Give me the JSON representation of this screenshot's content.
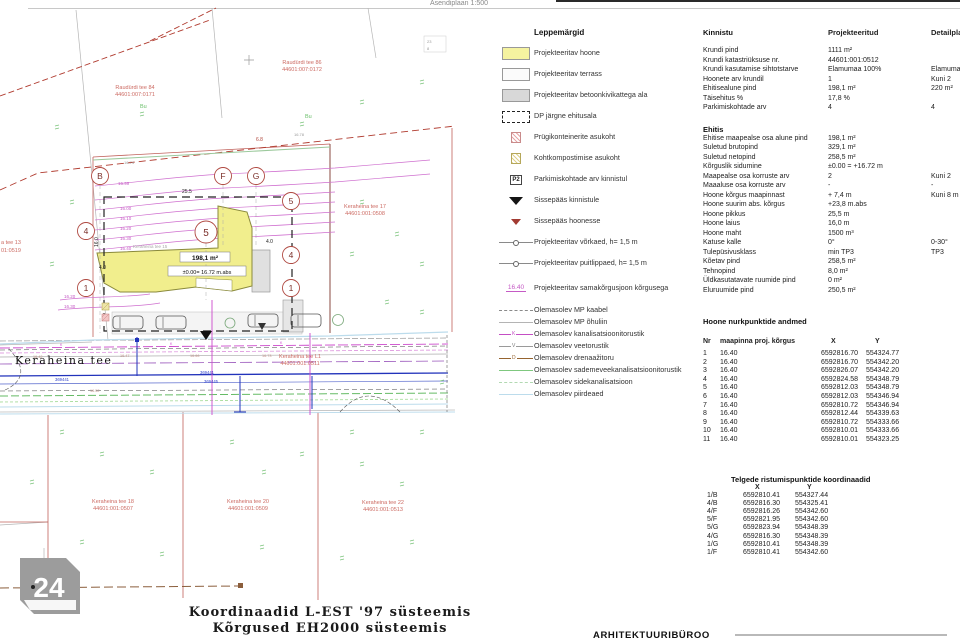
{
  "header": {
    "title": "Asendiplaan 1:500"
  },
  "legend": {
    "title": "Leppemärgid",
    "items": [
      {
        "symbol": "swatch-yellow",
        "label": "Projekteeritav hoone"
      },
      {
        "symbol": "swatch-white",
        "label": "Projekteeritav terrass"
      },
      {
        "symbol": "swatch-gray",
        "label": "Projekteeritav betoonkivikattega ala"
      },
      {
        "symbol": "dashed-bracket",
        "label": "DP järgne ehitusala"
      },
      {
        "symbol": "hatch-pink",
        "label": "Prügikonteinerite asukoht"
      },
      {
        "symbol": "hatch-yellow",
        "label": "Kohtkompostimise asukoht"
      },
      {
        "symbol": "p-box",
        "symbol_text": "P2",
        "label": "Parkimiskohtade arv kinnistul"
      },
      {
        "symbol": "triangle-black",
        "label": "Sissepääs kinnistule"
      },
      {
        "symbol": "triangle-red",
        "label": "Sissepääs hoonesse"
      },
      {
        "symbol": "fence-line",
        "label": "Projekteeritav võrkaed, h= 1,5 m"
      },
      {
        "symbol": "fence-line",
        "label": "Projekteeritav puitlippaed, h= 1,5 m"
      },
      {
        "symbol": "contour-label",
        "symbol_text": "16.40",
        "label": "Projekteeritav samakõrgusjoon kõrgusega"
      },
      {
        "symbol": "line-gray-dash",
        "label": "Olemasolev MP kaabel"
      },
      {
        "symbol": "line-gray",
        "label": "Olemasolev MP õhuliin"
      },
      {
        "symbol": "line-magenta",
        "symbol_text": "K",
        "label": "Olemasolev kanalisatsioonitorustik"
      },
      {
        "symbol": "line-gray-v",
        "symbol_text": "V",
        "label": "Olemasolev veetorustik"
      },
      {
        "symbol": "line-brown",
        "symbol_text": "D",
        "label": "Olemasolev drenaažitoru"
      },
      {
        "symbol": "line-green",
        "label": "Olemasolev sademeveekanalisatsioonitorustik"
      },
      {
        "symbol": "line-lightgreen",
        "label": "Olemasolev sidekanalisatsioon"
      },
      {
        "symbol": "line-lightblue",
        "label": "Olemasolev piirdeaed"
      }
    ]
  },
  "kinnistu": {
    "title": "Kinnistu",
    "col_projected": "Projekteeritud",
    "col_detail": "Detailplaneering",
    "rows": [
      {
        "label": "Krundi pind",
        "value": "1111 m²",
        "detail": ""
      },
      {
        "label": "Krundi katastriüksuse nr.",
        "value": "44601:001:0512",
        "detail": ""
      },
      {
        "label": "Krundi kasutamise sihtotstarve",
        "value": "Elamumaa 100%",
        "detail": "Elamumaa"
      },
      {
        "label": "Hoonete arv krundil",
        "value": "1",
        "detail": "Kuni 2"
      },
      {
        "label": "Ehitisealune pind",
        "value": "198,1 m²",
        "detail": "220 m²"
      },
      {
        "label": "Täisehitus %",
        "value": "17,8 %",
        "detail": ""
      },
      {
        "label": "Parkimiskohtade arv",
        "value": "4",
        "detail": "4"
      }
    ]
  },
  "ehitis": {
    "title": "Ehitis",
    "rows": [
      {
        "label": "Ehitise maapealse osa alune pind",
        "value": "198,1 m²",
        "detail": ""
      },
      {
        "label": "Suletud brutopind",
        "value": "329,1 m²",
        "detail": ""
      },
      {
        "label": "Suletud netopind",
        "value": "258,5 m²",
        "detail": ""
      },
      {
        "label": "Kõrguslik sidumine",
        "value": "±0.00 = +16.72 m",
        "detail": ""
      },
      {
        "label": "Maapealse osa korruste arv",
        "value": "2",
        "detail": "Kuni 2"
      },
      {
        "label": "Maaaluse osa korruste arv",
        "value": "-",
        "detail": "-"
      },
      {
        "label": "Hoone kõrgus maapinnast",
        "value": "+ 7,4 m",
        "detail": "Kuni 8 m"
      },
      {
        "label": "Hoone suurim abs. kõrgus",
        "value": "+23,8 m.abs",
        "detail": ""
      },
      {
        "label": "Hoone pikkus",
        "value": "25,5 m",
        "detail": ""
      },
      {
        "label": "Hoone laius",
        "value": "16,0 m",
        "detail": ""
      },
      {
        "label": "Hoone maht",
        "value": "1500 m³",
        "detail": ""
      },
      {
        "label": "Katuse kalle",
        "value": "0°",
        "detail": "0-30°"
      },
      {
        "label": "Tulepüsivusklass",
        "value": "min TP3",
        "detail": "TP3"
      },
      {
        "label": "Kõetav pind",
        "value": "258,5 m²",
        "detail": ""
      },
      {
        "label": "Tehnopind",
        "value": "8,0 m²",
        "detail": ""
      },
      {
        "label": "Üldkasutatavate ruumide pind",
        "value": "0 m²",
        "detail": ""
      },
      {
        "label": "Eluruumide pind",
        "value": "250,5 m²",
        "detail": ""
      }
    ]
  },
  "corner_points": {
    "title": "Hoone nurkpunktide andmed",
    "col_nr": "Nr",
    "col_h": "maapinna proj. kõrgus",
    "col_x": "X",
    "col_y": "Y",
    "rows": [
      {
        "nr": "1",
        "h": "16.40",
        "x": "6592816.70",
        "y": "554324.77"
      },
      {
        "nr": "2",
        "h": "16.40",
        "x": "6592816.70",
        "y": "554342.20"
      },
      {
        "nr": "3",
        "h": "16.40",
        "x": "6592826.07",
        "y": "554342.20"
      },
      {
        "nr": "4",
        "h": "16.40",
        "x": "6592824.58",
        "y": "554348.79"
      },
      {
        "nr": "5",
        "h": "16.40",
        "x": "6592812.03",
        "y": "554348.79"
      },
      {
        "nr": "6",
        "h": "16.40",
        "x": "6592812.03",
        "y": "554346.94"
      },
      {
        "nr": "7",
        "h": "16.40",
        "x": "6592810.72",
        "y": "554346.94"
      },
      {
        "nr": "8",
        "h": "16.40",
        "x": "6592812.44",
        "y": "554339.63"
      },
      {
        "nr": "9",
        "h": "16.40",
        "x": "6592810.72",
        "y": "554333.66"
      },
      {
        "nr": "10",
        "h": "16.40",
        "x": "6592810.01",
        "y": "554333.66"
      },
      {
        "nr": "11",
        "h": "16.40",
        "x": "6592810.01",
        "y": "554323.25"
      }
    ]
  },
  "axis_points": {
    "title": "Telgede ristumispunktide koordinaadid",
    "col_x": "X",
    "col_y": "Y",
    "rows": [
      {
        "id": "1/B",
        "x": "6592810.41",
        "y": "554327.44"
      },
      {
        "id": "4/B",
        "x": "6592816.30",
        "y": "554325.41"
      },
      {
        "id": "4/F",
        "x": "6592816.26",
        "y": "554342.60"
      },
      {
        "id": "5/F",
        "x": "6592821.95",
        "y": "554342.60"
      },
      {
        "id": "5/G",
        "x": "6592823.94",
        "y": "554348.39"
      },
      {
        "id": "4/G",
        "x": "6592816.30",
        "y": "554348.39"
      },
      {
        "id": "1/G",
        "x": "6592810.41",
        "y": "554348.39"
      },
      {
        "id": "1/F",
        "x": "6592810.41",
        "y": "554342.60"
      }
    ]
  },
  "plan": {
    "parcels": {
      "raudurdi84": {
        "name": "Raudürdi tee 84",
        "cad": "44601:007:0171"
      },
      "raudurdi86": {
        "name": "Raudürdi tee 86",
        "cad": "44601:007:0172"
      },
      "keraheina13": {
        "name": "a tee 13",
        "cad": "01:0519"
      },
      "keraheina17": {
        "name": "Keraheina tee 17",
        "cad": "44601:001:0508"
      },
      "keraheina18": {
        "name": "Keraheina tee 18",
        "cad": "44601:001:0507"
      },
      "keraheina20": {
        "name": "Keraheina tee 20",
        "cad": "44601:001:0509"
      },
      "keraheina22": {
        "name": "Keraheina tee 22",
        "cad": "44601:001:0513"
      },
      "keraheinaL1": {
        "name": "Keraheina tee L1",
        "cad": "44601:001:0511"
      }
    },
    "street_name": "Keraheina tee",
    "site_label": "Keraheina tee 15",
    "building": {
      "area": "198,1 m²",
      "level": "±0.00= 16.72 m.abs"
    },
    "dims": {
      "d255": "25.5",
      "d160": "16.0",
      "d40": "4.0",
      "d68": "6.8",
      "d1674": "16.74",
      "d1678": "16.78"
    },
    "axes": {
      "b": "B",
      "f": "F",
      "g": "G",
      "n1": "1",
      "n4": "4",
      "n5": "5"
    },
    "contours": {
      "c0": "15.99",
      "c1": "16.00",
      "c2": "16.10",
      "c3": "16.20",
      "c4": "16.30",
      "c5": "16.40"
    },
    "veg_label": "Bu",
    "utility_ids": {
      "u1": "369441",
      "u2": "369445"
    },
    "spot_heights": {
      "s1": "16.42",
      "s2": "16.47",
      "s3": "16.66",
      "s4": "16.73",
      "s5": "16.52"
    },
    "corner_note": {
      "a": "23",
      "b": "8"
    }
  },
  "footer": {
    "coord_line1": "Koordinaadid L-EST '97 süsteemis",
    "coord_line2": "Kõrgused EH2000 süsteemis",
    "stamp": "ARHITEKTUURIBÜROO",
    "sheet_number": "24"
  }
}
